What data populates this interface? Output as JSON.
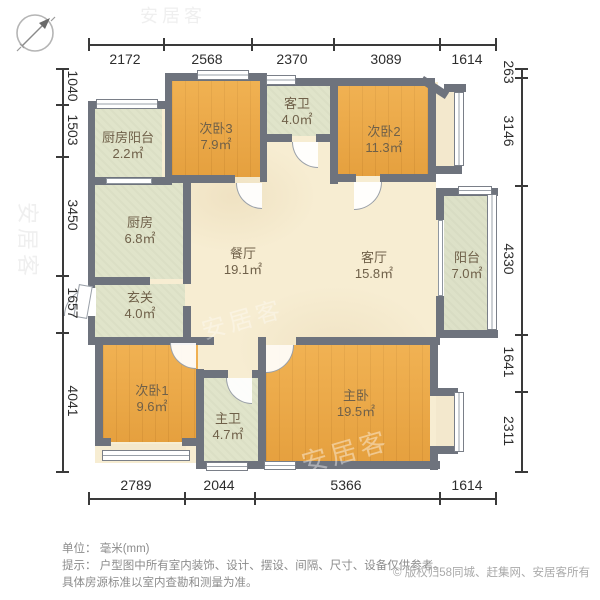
{
  "dimensions": {
    "top": [
      "2172",
      "2568",
      "2370",
      "3089",
      "1614"
    ],
    "bottom": [
      "2789",
      "2044",
      "5366",
      "1614"
    ],
    "left": [
      "1040",
      "1503",
      "3450",
      "1657",
      "4041"
    ],
    "right": [
      "263",
      "3146",
      "4330",
      "1641",
      "2311"
    ]
  },
  "rooms": [
    {
      "id": "kitchen-balcony",
      "name": "厨房阳台",
      "area": "2.2㎡"
    },
    {
      "id": "bedroom-3",
      "name": "次卧3",
      "area": "7.9㎡"
    },
    {
      "id": "guest-bathroom",
      "name": "客卫",
      "area": "4.0㎡"
    },
    {
      "id": "bedroom-2",
      "name": "次卧2",
      "area": "11.3㎡"
    },
    {
      "id": "kitchen",
      "name": "厨房",
      "area": "6.8㎡"
    },
    {
      "id": "dining-room",
      "name": "餐厅",
      "area": "19.1㎡"
    },
    {
      "id": "living-room",
      "name": "客厅",
      "area": "15.8㎡"
    },
    {
      "id": "balcony",
      "name": "阳台",
      "area": "7.0㎡"
    },
    {
      "id": "entry",
      "name": "玄关",
      "area": "4.0㎡"
    },
    {
      "id": "bedroom-1",
      "name": "次卧1",
      "area": "9.6㎡"
    },
    {
      "id": "master-bathroom",
      "name": "主卫",
      "area": "4.7㎡"
    },
    {
      "id": "master-bedroom",
      "name": "主卧",
      "area": "19.5㎡"
    }
  ],
  "footer": {
    "unit": "单位： 毫米(mm)",
    "tip": "提示： 户型图中所有室内装饰、设计、摆设、间隔、尺寸、设备仅供参考。",
    "tip2": "具体房源标准以室内查勘和测量为准。",
    "copyright": "© 版权归58同城、赶集网、安居客所有"
  },
  "watermark": {
    "text": "安居客"
  },
  "colors": {
    "wall": "#6e737d",
    "wood": "#eca743",
    "tile": "#e0e4ca",
    "hall": "#f7edd2",
    "dimension": "#3a3a3a"
  }
}
